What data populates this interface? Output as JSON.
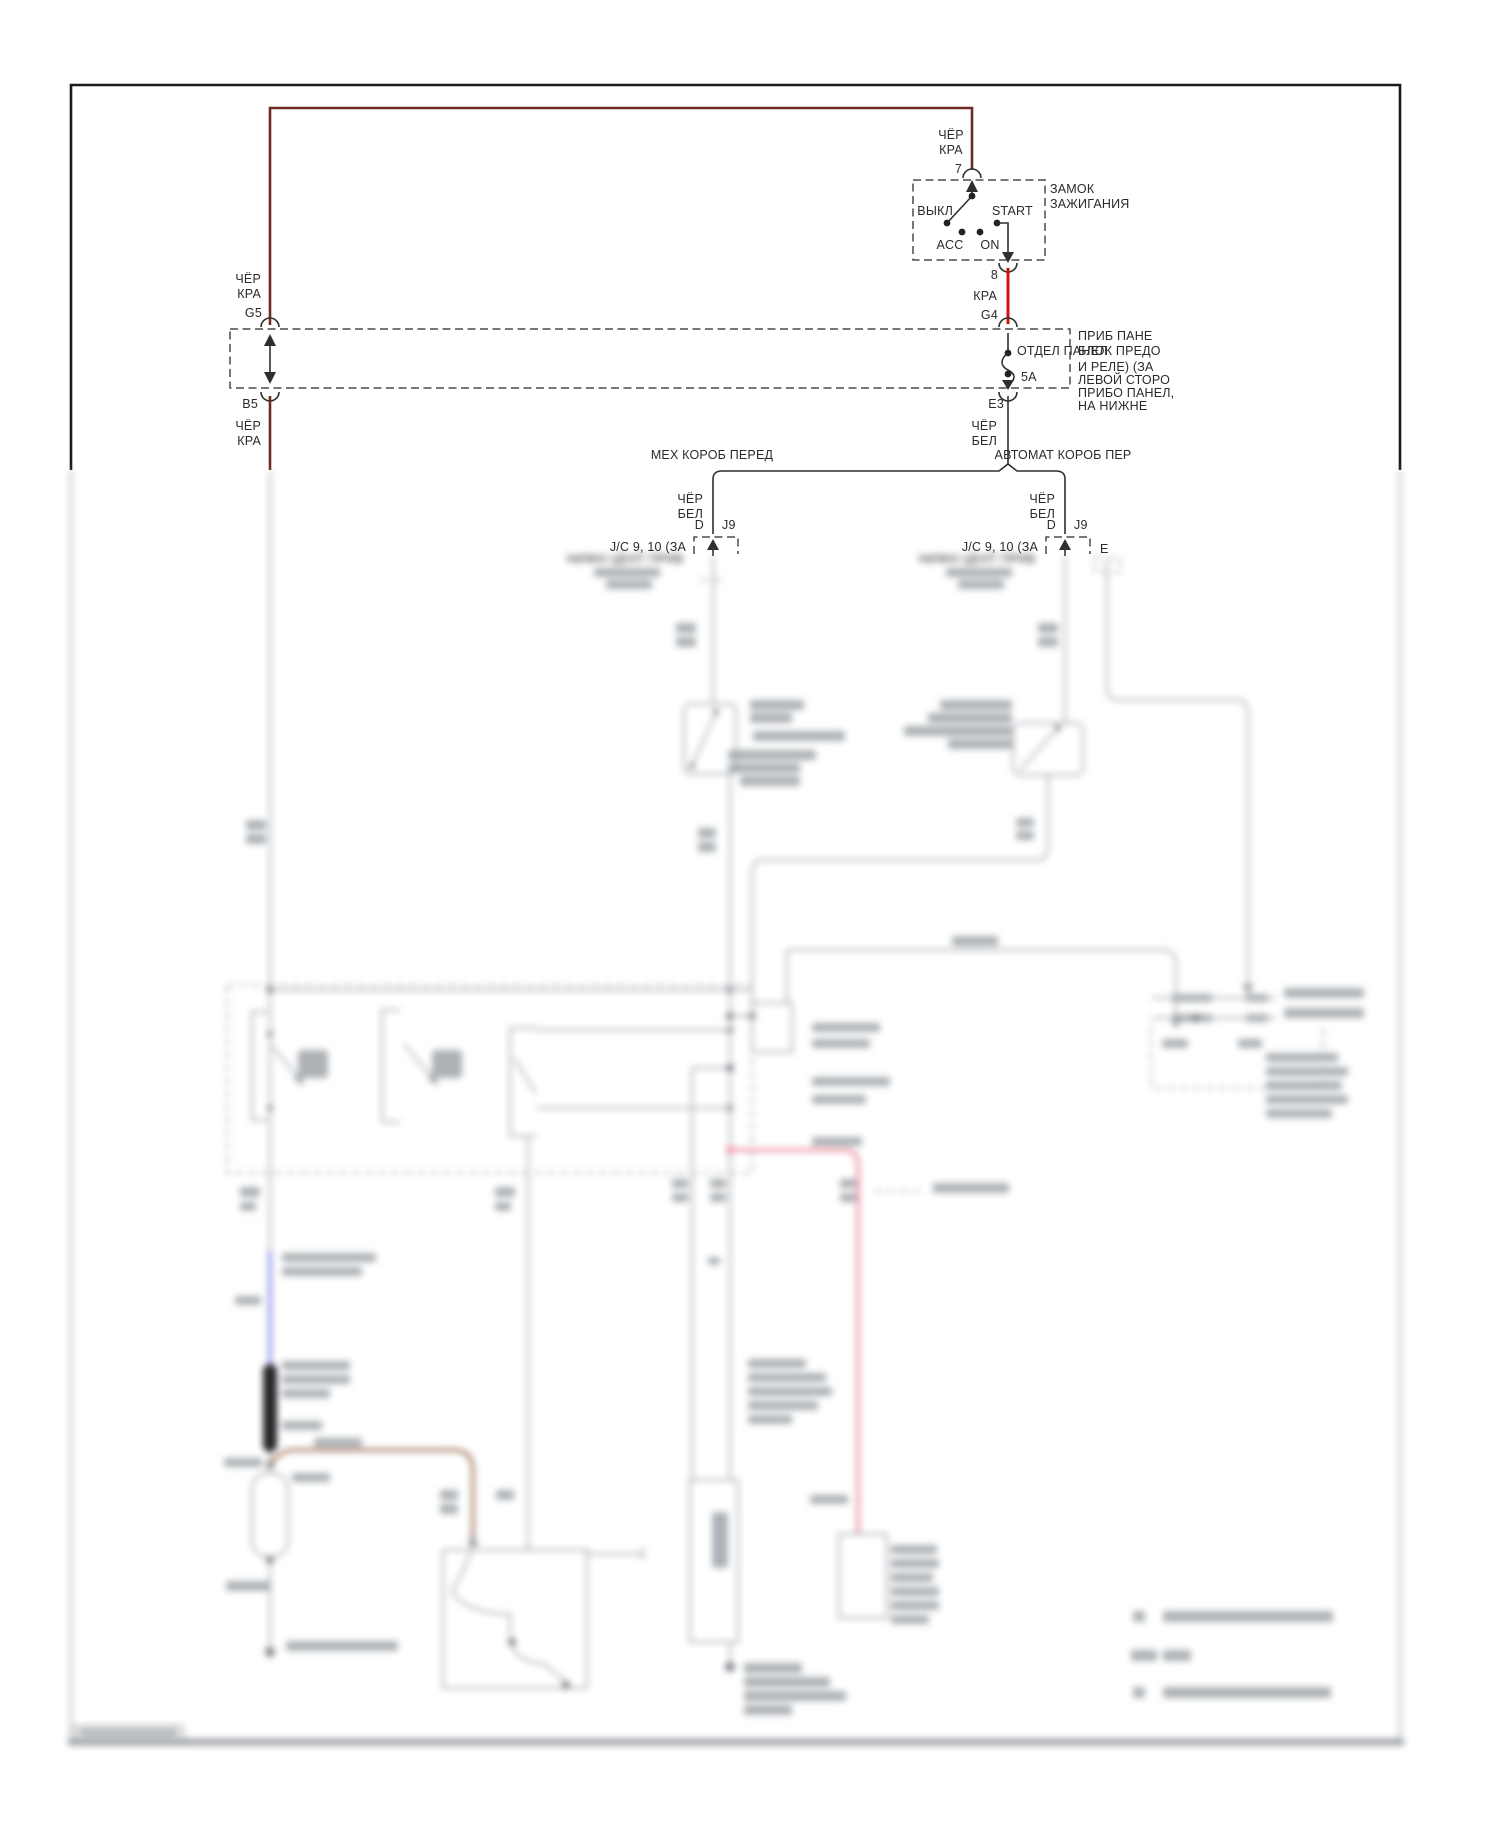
{
  "colors": {
    "wire-darkred": "#6e2b22",
    "wire-red": "#c81414",
    "wire-blue": "#7d7de6",
    "wire-pink": "#ef93a4",
    "wire-brown": "#9b6b52",
    "blur-gray": "#a9adb2"
  },
  "ignition": {
    "title_l1": "ЗАМОК",
    "title_l2": "ЗАЖИГАНИЯ",
    "pin_top": "7",
    "pin_bottom": "8",
    "pos_off": "ВЫКЛ",
    "pos_acc": "ACC",
    "pos_on": "ON",
    "pos_start": "START",
    "wire_in_l1": "ЧЁР",
    "wire_in_l2": "КРА",
    "wire_out": "КРА"
  },
  "fuse_panel": {
    "pin_g5": "G5",
    "pin_b5": "B5",
    "pin_g4": "G4",
    "pin_e3": "E3",
    "fuse_rating": "5A",
    "inner_label": "ОТДЕЛ ПАНЕЛ",
    "in_left_l1": "ЧЁР",
    "in_left_l2": "КРА",
    "out_left_l1": "ЧЁР",
    "out_left_l2": "КРА",
    "out_right_l1": "ЧЁР",
    "out_right_l2": "БЕЛ",
    "note_l1": "ПРИБ ПАНЕ",
    "note_l2": "БЛОК ПРЕДО",
    "note_l3": "И РЕЛЕ) (ЗА",
    "note_l4": "ЛЕВОЙ СТОРО",
    "note_l5": "ПРИБО ПАНЕЛ,",
    "note_l6": "НА НИЖНЕ"
  },
  "branches": {
    "left_title": "МЕХ КОРОБ ПЕРЕД",
    "right_title": "АВТОМАТ КОРОБ ПЕР",
    "wire_l1": "ЧЁР",
    "wire_l2": "БЕЛ",
    "pin_d": "D",
    "pin_j9": "J9",
    "jc_note": "J/C 9, 10 (ЗА",
    "jc_note2": "НИЖН ЦЕНТ ПРИБ",
    "pin_e": "E"
  }
}
